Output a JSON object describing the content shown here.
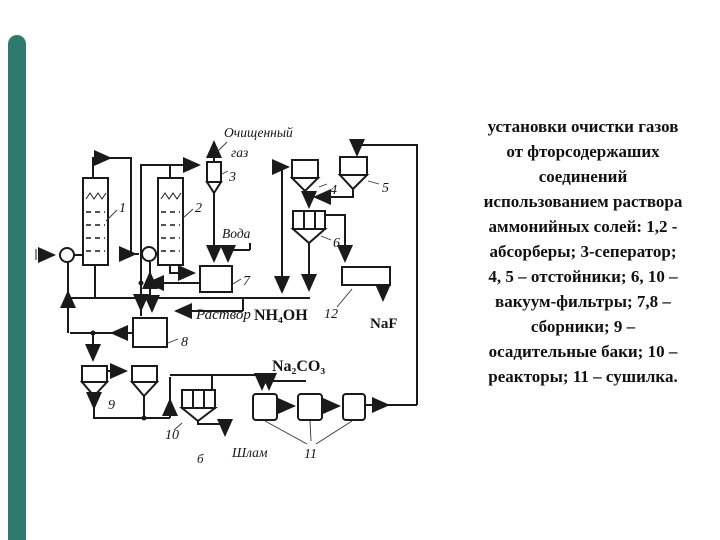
{
  "accent": {
    "color": "#2e7a6e"
  },
  "caption": {
    "lines": [
      "установки очистки газов",
      "от фторсодержаших",
      "соединений",
      "использованием раствора",
      "аммонийных солей: 1,2 -",
      "абсорберы; 3-сеператор;",
      "4, 5 – отстойники; 6, 10 –",
      "вакуум-фильтры; 7,8 –",
      "сборники; 9 –",
      "осадительные баки; 10 –",
      "реакторы; 11 – сушилка."
    ]
  },
  "diagram": {
    "streams": {
      "purified_gas_1": "Очищенный",
      "purified_gas_2": "газ",
      "water": "Вода",
      "solution_word": "Раствор",
      "ammonia_formula": "NH₄OH",
      "soda_formula": "Na₂CO₃",
      "naf_formula": "NaF",
      "sludge": "Шлам",
      "b_mark": "б"
    },
    "numbers": {
      "n1": "1",
      "n2": "2",
      "n3": "3",
      "n4": "4",
      "n5": "5",
      "n6": "6",
      "n7": "7",
      "n8": "8",
      "n9": "9",
      "n10": "10",
      "n11": "11",
      "n12": "12"
    }
  }
}
